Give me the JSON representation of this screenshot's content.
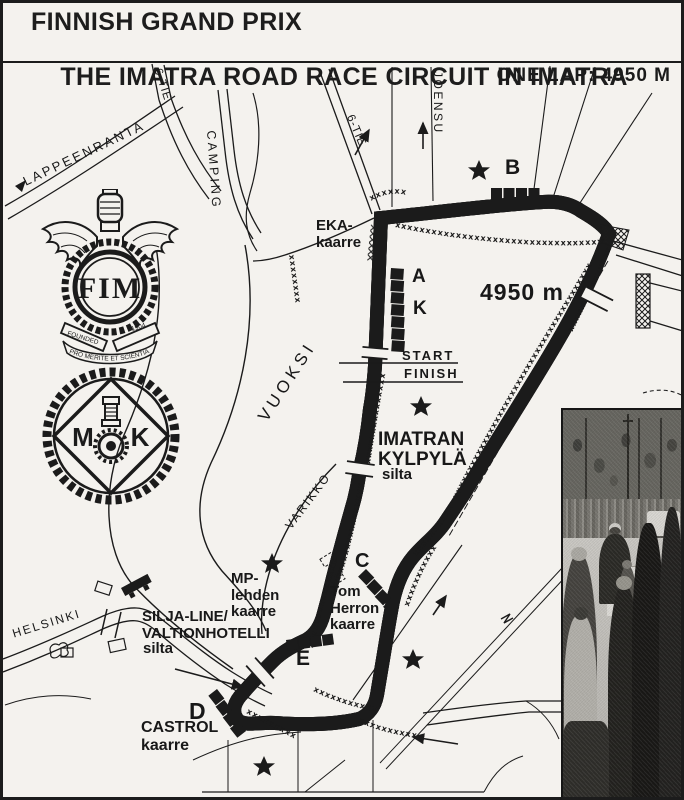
{
  "header": {
    "title_line1": "FINNISH GRAND PRIX",
    "title_line2": "THE IMATRA ROAD RACE CIRCUIT IN IMATRA",
    "lap_info": "ONE LAP: 4950 M"
  },
  "logos": {
    "fim": {
      "letters": "FIM",
      "founded": "FOUNDED",
      "year": "1904",
      "motto": "PRO MERITE ET SCIENTIA"
    },
    "mk": {
      "m": "M",
      "k": "K"
    }
  },
  "map": {
    "labels": {
      "lappeenranta": "LAPPEENRANTA",
      "six_tie_upper": "6-TIE",
      "camping": "CAMPING",
      "six_tie_lower": "6-TIE",
      "joensu": "JOENSU",
      "eka_kaarre": "EKA-\nkaarre",
      "stand_b": "B",
      "stand_a": "A",
      "stand_k": "K",
      "lap_length": "4950 m",
      "start": "START",
      "finish": "FINISH",
      "vuoksi": "VUOKSI",
      "imatran_kylpyla": "IMATRAN\nKYLPYLÄ",
      "kylpyla_silta": "silta",
      "varikko": "VARIKKO",
      "mp_lehden_kaarre": "MP-\nlehden\nkaarre",
      "stand_c": "C",
      "tom_herron_kaarre": "Tom\nHerron\nkaarre",
      "silja_valtionhotelli": "SILJA-LINE/\nVALTIONHOTELLI",
      "silja_silta": "silta",
      "stand_e": "E",
      "stand_d": "D",
      "castrol_kaarre": "CASTROL\nkaarre",
      "helsinki": "HELSINKI"
    },
    "colors": {
      "paper": "#f4f2ee",
      "ink": "#1b1b1b"
    }
  }
}
